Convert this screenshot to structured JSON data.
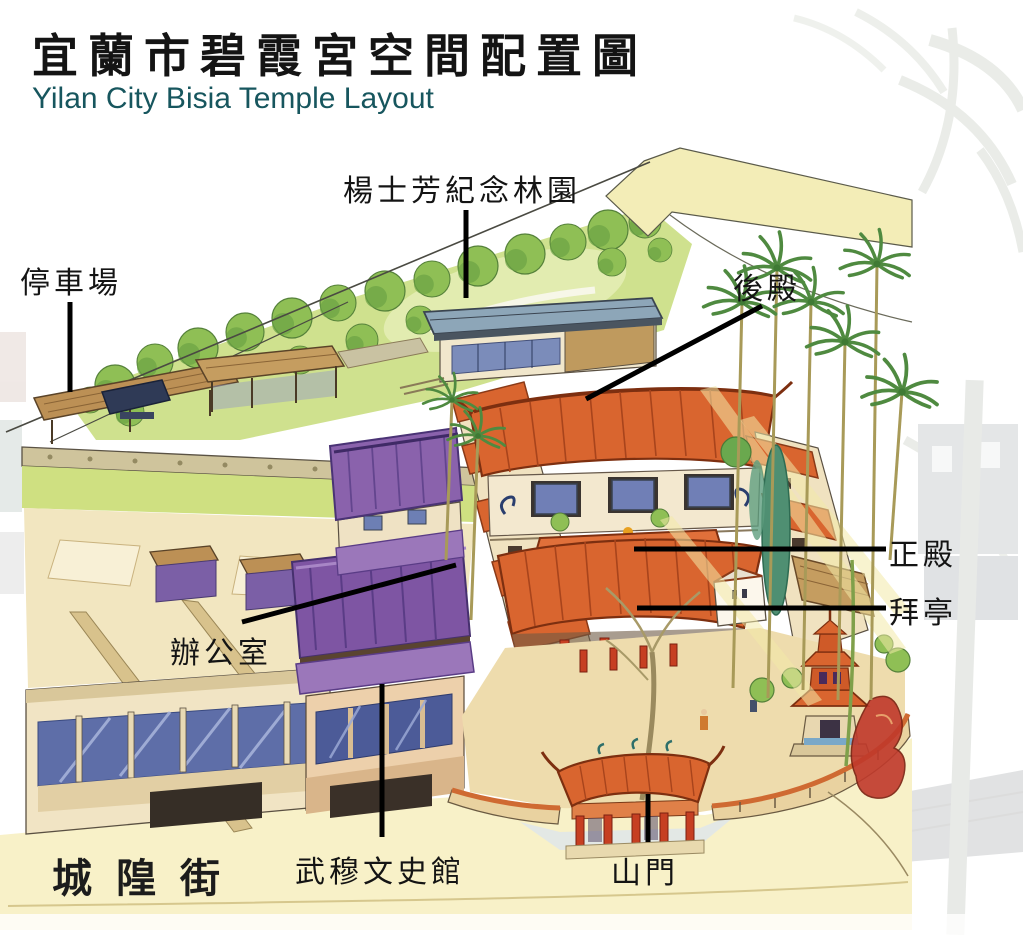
{
  "header": {
    "title_zh": "宜蘭市碧霞宮空間配置圖",
    "subtitle_en": "Yilan City Bisia Temple Layout"
  },
  "map_labels": {
    "memorial_garden": "楊士芳紀念林園",
    "parking_lot": "停車場",
    "rear_hall": "後殿",
    "main_hall": "正殿",
    "worship_pavilion": "拜亭",
    "office": "辦公室",
    "wumu_history_museum": "武穆文史館",
    "mountain_gate": "山門",
    "street_name": "城隍街"
  },
  "colors": {
    "subtitle_teal": "#17565E",
    "label_black": "#141414",
    "temple_roof_orange": "#D9652F",
    "museum_roof_purple": "#7E55A3",
    "memorial_roof_slate": "#8DA6B8",
    "ground_cream": "#F2E6C0",
    "street_yellow": "#F8F1C8",
    "foliage_green": "#8FBF55",
    "column_red": "#C63F22",
    "callout_line": "#000000"
  }
}
